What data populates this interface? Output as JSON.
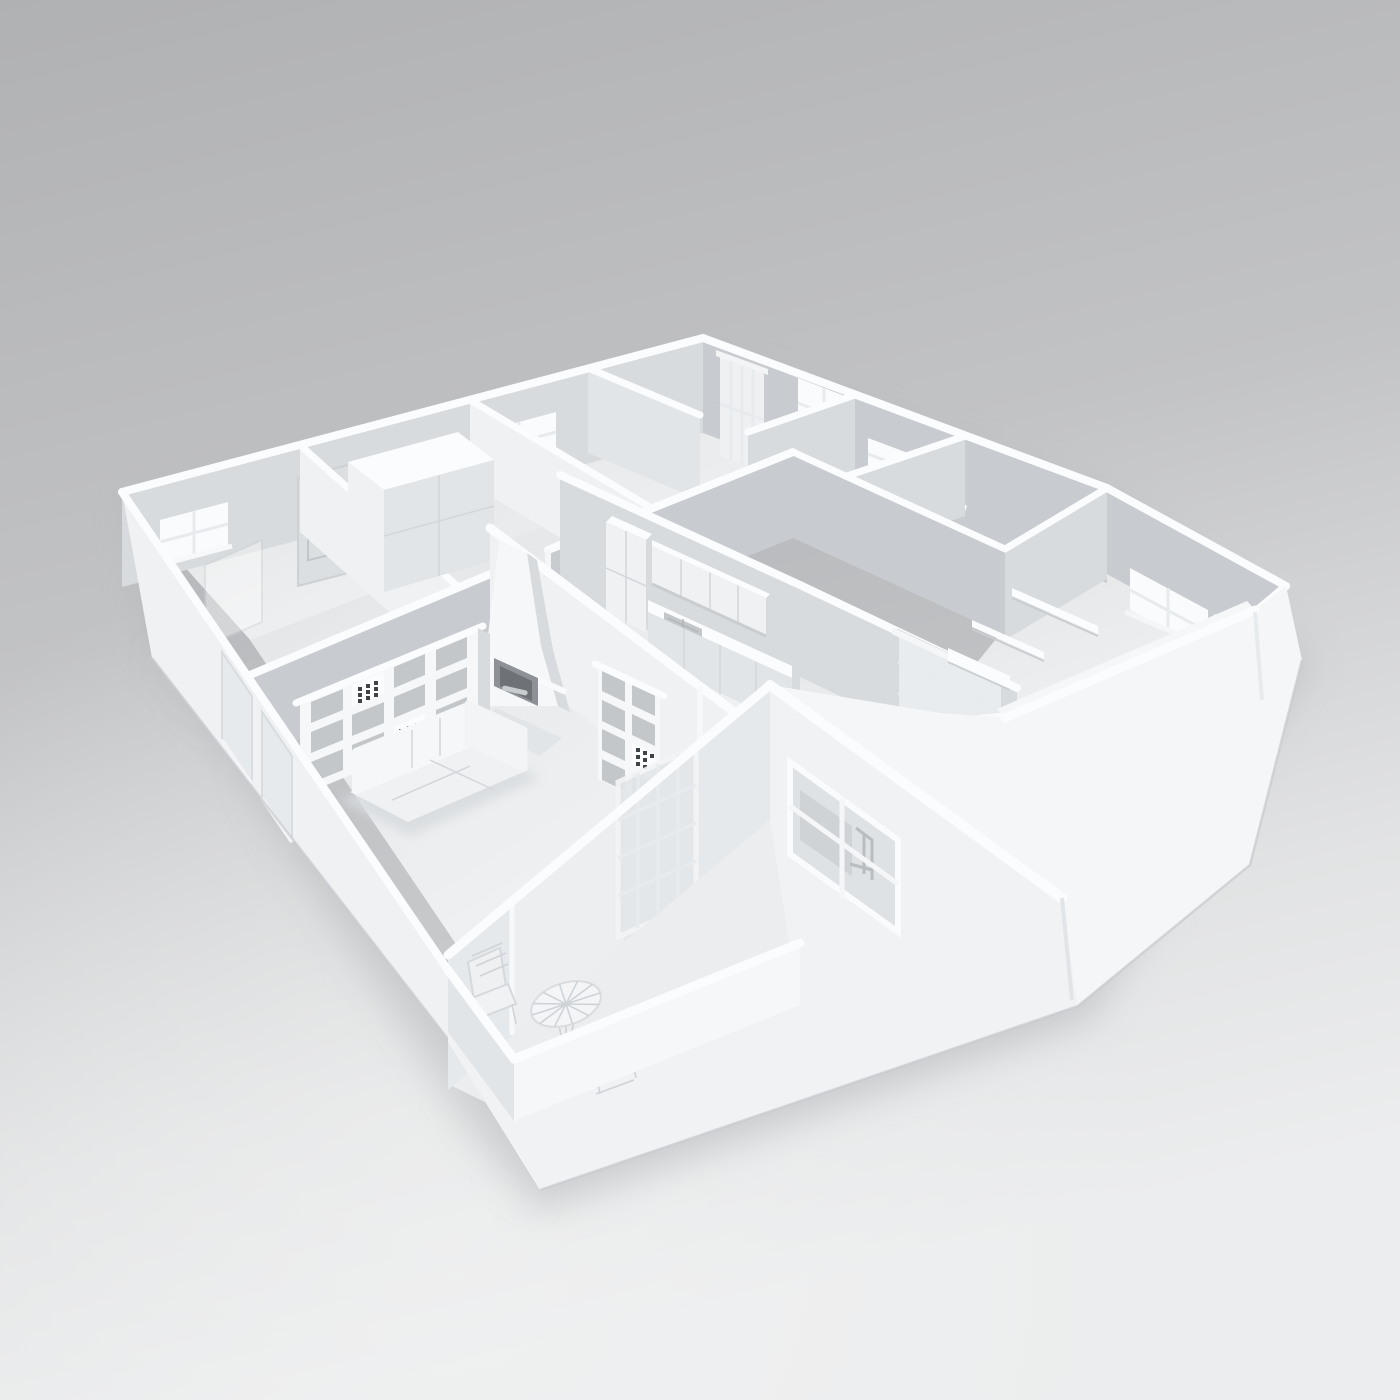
{
  "scene": {
    "type": "3d-architectural-render",
    "subject": "monochrome white clay-render 3D floor plan model of an apartment, dollhouse cutaway view from above",
    "background": {
      "top": "#b1b2b4",
      "bottom": "#ecedee"
    },
    "palette": {
      "wall_top": "#fbfcfd",
      "wall_face_light": "#eff1f3",
      "wall_face_medium": "#d8dbde",
      "wall_face_dark": "#c8cbcf",
      "exterior_bright": "#f4f6f7",
      "floor": "#e7e9eb",
      "floor_bright": "#f0f2f3",
      "glass": "#eef0f2",
      "ground_shadow": "#b4b6b9",
      "detail_dark": "#3f4347"
    },
    "rooms": [
      {
        "name": "bathroom-small",
        "features": [
          "window",
          "glass shower screen"
        ]
      },
      {
        "name": "entry-hall",
        "features": [
          "front door with arched glazing",
          "wardrobe cabinet"
        ]
      },
      {
        "name": "back-bedroom",
        "features": [
          "window with sill"
        ]
      },
      {
        "name": "study-back",
        "features": [
          "tall glazed door",
          "four-pane window"
        ]
      },
      {
        "name": "bathroom-main",
        "features": [
          "wide sill window"
        ]
      },
      {
        "name": "kitchen",
        "features": [
          "tall cabinet",
          "upper cabinets",
          "counter with double sink",
          "base cabinets"
        ]
      },
      {
        "name": "living-room",
        "features": [
          "fireplace with tapered chimney",
          "cube shelving 4x3",
          "cube shelving 2x4",
          "corner sofa",
          "sliding glass door"
        ]
      },
      {
        "name": "corridor",
        "features": [
          "french glazed door"
        ]
      },
      {
        "name": "bedroom-wing",
        "features": [
          "bed with crumpled duvet",
          "floating wall shelves",
          "desk ledge",
          "three-pane window"
        ]
      },
      {
        "name": "study-front",
        "features": [
          "large cross window",
          "desk and chair visible through glass"
        ]
      },
      {
        "name": "terrace",
        "features": [
          "low parapet",
          "round bistro table",
          "two wire chairs"
        ]
      }
    ],
    "objects": [
      "front-door",
      "wardrobe",
      "shower-screen",
      "fireplace",
      "kitchen-cabinets",
      "cube-shelf-large",
      "cube-shelf-small",
      "corner-sofa",
      "sliding-glass-door",
      "french-door",
      "bed",
      "wall-shelves",
      "desk-ledge",
      "bistro-table",
      "wire-chair-left",
      "wire-chair-right"
    ]
  }
}
